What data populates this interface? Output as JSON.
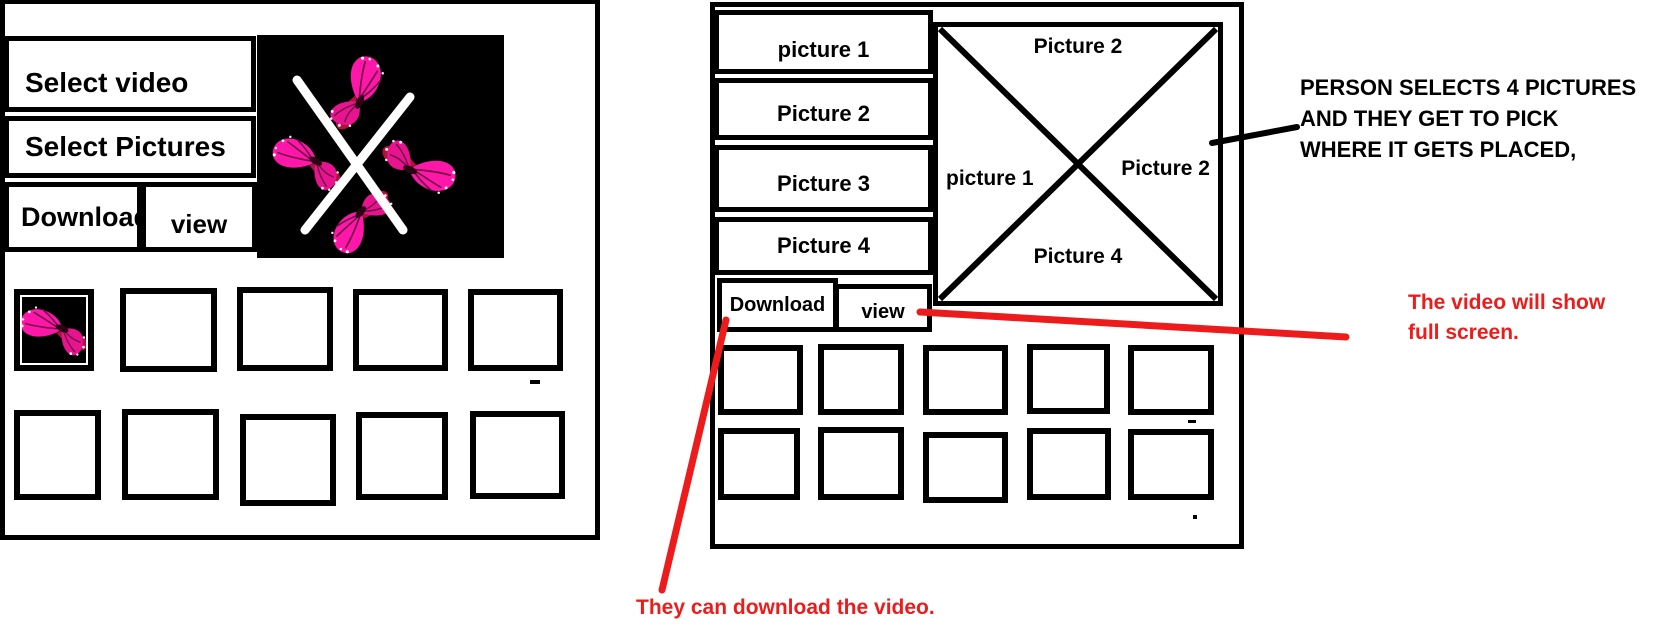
{
  "colors": {
    "accent_red": "#ed1c1c",
    "butterfly_pink": "#ff17a9",
    "butterfly_deep_pink": "#e8138f",
    "black": "#000000",
    "white": "#ffffff"
  },
  "left_panel": {
    "select_video_label": "Select video",
    "select_pictures_label": "Select Pictures",
    "download_label": "Download",
    "view_label": "view",
    "video_preview": {
      "icon": "butterflies-x-video-icon",
      "background": "#000000"
    },
    "gallery": {
      "rows": 2,
      "cols": 5,
      "first_thumbnail": "butterfly-image"
    }
  },
  "right_panel": {
    "picture_buttons": [
      "picture 1",
      "Picture 2",
      "Picture 3",
      "Picture 4"
    ],
    "download_label": "Download",
    "view_label": "view",
    "placement_box": {
      "top": "Picture 2",
      "left": "picture 1",
      "right": "Picture 2",
      "bottom": "Picture 4"
    },
    "gallery": {
      "rows": 2,
      "cols": 5
    }
  },
  "annotations": {
    "selection_note": {
      "lines": [
        "PERSON SELECTS 4 PICTURES",
        "AND THEY GET TO PICK",
        "WHERE IT GETS PLACED,"
      ],
      "color": "#000000"
    },
    "fullscreen_note": {
      "lines": [
        "The video will show",
        "full screen."
      ],
      "color": "#ed1c1c"
    },
    "download_note": {
      "text": "They can download the video.",
      "color": "#ed1c1c"
    }
  }
}
